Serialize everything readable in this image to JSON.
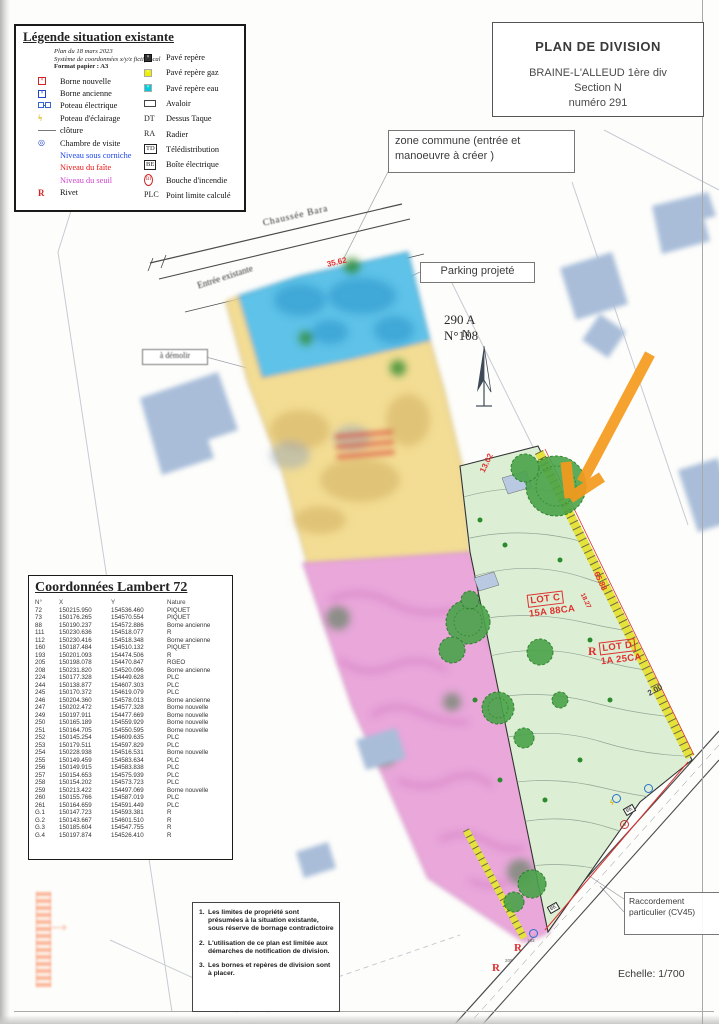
{
  "title_block": {
    "title": "PLAN DE DIVISION",
    "subtitle": "BRAINE-L'ALLEUD 1ère div\nSection N\nnuméro 291"
  },
  "legend": {
    "title": "Légende situation existante",
    "meta_line1": "Plan du 18 mars 2023",
    "meta_line2": "Système de coordonnées x/y/z fictif local",
    "meta_line3": "Format papier : A3",
    "left": [
      {
        "sq": "#fff",
        "bd": "#d42222",
        "x": "#d42222",
        "label": "Borne nouvelle"
      },
      {
        "sq": "#fff",
        "bd": "#2244cc",
        "x": "#2244cc",
        "label": "Borne ancienne"
      },
      {
        "pe": true,
        "label": "Poteau électrique"
      },
      {
        "g": "ϟ",
        "gc": "#d8b400",
        "boldg": true,
        "label": "Poteau d'éclairage"
      },
      {
        "line": true,
        "label": "clôture"
      },
      {
        "g": "◎",
        "gc": "#2244cc",
        "label": "Chambre de visite"
      },
      {
        "label": "Niveau sous corniche",
        "lc": "#1a44ee"
      },
      {
        "label": "Niveau du faîte",
        "lc": "#ee1111"
      },
      {
        "label": "Niveau du seuil",
        "lc": "#cc44cc"
      },
      {
        "g": "R",
        "gc": "#d42222",
        "boldg": true,
        "label": "Rivet"
      }
    ],
    "right": [
      {
        "sq": "#333",
        "bd": "#111",
        "x": "#fff",
        "label": "Pavé repère"
      },
      {
        "sq": "#ee0",
        "bd": "#aaa",
        "x": "#fff",
        "label": "Pavé repère gaz"
      },
      {
        "sq": "#0cd",
        "bd": "#aaa",
        "x": "#fff",
        "label": "Pavé repère eau"
      },
      {
        "rect": true,
        "label": "Avaloir"
      },
      {
        "g": "DT",
        "label": "Dessus Taque"
      },
      {
        "g": "RA",
        "label": "Radier"
      },
      {
        "g": "TD",
        "box": true,
        "label": "Télédistribution"
      },
      {
        "g": "BE",
        "box": true,
        "label": "Boîte électrique"
      },
      {
        "g": "BI",
        "circ": true,
        "label": "Bouche d'incendie"
      },
      {
        "g": "PLC",
        "label": "Point limite calculé"
      }
    ]
  },
  "callouts": {
    "zone_commune": "zone commune  (entrée et\nmanoeuvre à créer )",
    "parking": "Parking projeté",
    "demolir": "à démolir",
    "raccordement": "Raccordement\nparticulier (CV45)",
    "parcel_ref": "290 A\nN°108",
    "north": "N",
    "scale": "Echelle: 1/700"
  },
  "map": {
    "street_top": "Chaussée Bara",
    "entrance": "Entrée existante",
    "lot_c": {
      "name": "LOT C",
      "area": "15A 88CA"
    },
    "lot_d": {
      "name": "LOT D",
      "area": "1A 25CA"
    },
    "dim1": "35.62",
    "dim2": "13.02",
    "dim3": "65.88",
    "dim4": "18.27",
    "dim5": "2.00",
    "r_mark": "R",
    "pt193": "193",
    "pt205": "205",
    "icon_be": "BE",
    "icon_bi": "BI",
    "icon_bolt": "ϟ"
  },
  "notes": {
    "items": [
      "Les limites de propriété sont présumées à la situation existante, sous réserve de bornage contradictoire",
      "L'utilisation de ce plan est limitée aux démarches de notification de division.",
      "Les bornes et repères de division sont à placer."
    ]
  },
  "coords_table": {
    "title": "Coordonnées Lambert 72",
    "headers": [
      "N°",
      "X",
      "Y",
      "Nature"
    ],
    "rows": [
      [
        "72",
        "150215.950",
        "154536.460",
        "PIQUET"
      ],
      [
        "73",
        "150176.265",
        "154570.554",
        "PIQUET"
      ],
      [
        "88",
        "150190.237",
        "154572.886",
        "Borne ancienne"
      ],
      [
        "111",
        "150230.636",
        "154518.077",
        "R"
      ],
      [
        "112",
        "150230.416",
        "154518.348",
        "Borne ancienne"
      ],
      [
        "160",
        "150187.484",
        "154510.132",
        "PIQUET"
      ],
      [
        "193",
        "150201.093",
        "154474.506",
        "R"
      ],
      [
        "205",
        "150198.078",
        "154470.847",
        "RGEO"
      ],
      [
        "208",
        "150231.820",
        "154520.096",
        "Borne ancienne"
      ],
      [
        "224",
        "150177.328",
        "154449.628",
        "PLC"
      ],
      [
        "244",
        "150138.877",
        "154607.303",
        "PLC"
      ],
      [
        "245",
        "150170.372",
        "154619.079",
        "PLC"
      ],
      [
        "246",
        "150204.360",
        "154578.013",
        "Borne ancienne"
      ],
      [
        "247",
        "150202.472",
        "154577.328",
        "Borne nouvelle"
      ],
      [
        "249",
        "150197.911",
        "154477.669",
        "Borne nouvelle"
      ],
      [
        "250",
        "150165.189",
        "154559.929",
        "Borne nouvelle"
      ],
      [
        "251",
        "150164.705",
        "154550.595",
        "Borne nouvelle"
      ],
      [
        "252",
        "150145.254",
        "154609.635",
        "PLC"
      ],
      [
        "253",
        "150179.511",
        "154597.829",
        "PLC"
      ],
      [
        "254",
        "150228.938",
        "154516.531",
        "Borne nouvelle"
      ],
      [
        "255",
        "150149.459",
        "154583.634",
        "PLC"
      ],
      [
        "256",
        "150149.915",
        "154583.838",
        "PLC"
      ],
      [
        "257",
        "150154.653",
        "154575.939",
        "PLC"
      ],
      [
        "258",
        "150154.202",
        "154573.723",
        "PLC"
      ],
      [
        "259",
        "150213.422",
        "154497.069",
        "Borne nouvelle"
      ],
      [
        "260",
        "150155.766",
        "154587.019",
        "PLC"
      ],
      [
        "261",
        "150164.659",
        "154591.449",
        "PLC"
      ],
      [
        "G.1",
        "150147.723",
        "154593.381",
        "R"
      ],
      [
        "G.2",
        "150143.667",
        "154601.510",
        "R"
      ],
      [
        "G.3",
        "150185.604",
        "154547.755",
        "R"
      ],
      [
        "G.4",
        "150197.874",
        "154526.410",
        "R"
      ]
    ]
  }
}
